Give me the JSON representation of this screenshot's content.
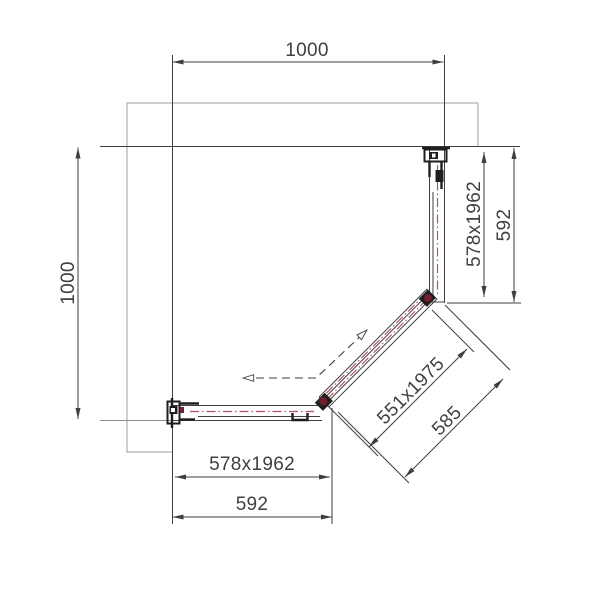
{
  "drawing": {
    "dimensions": {
      "top_width": "1000",
      "left_height": "1000",
      "right_glass": "578x1962",
      "right_width": "592",
      "diagonal_glass": "551x1975",
      "diagonal_width": "585",
      "bottom_glass": "578x1962",
      "bottom_width": "592"
    },
    "colors": {
      "line": "#3f3f3f",
      "thin": "#9e9e9e",
      "mid": "#8f8f8f",
      "glass": "#b65268",
      "hardware": "#70202e",
      "ink": "#1e1e1e"
    }
  }
}
